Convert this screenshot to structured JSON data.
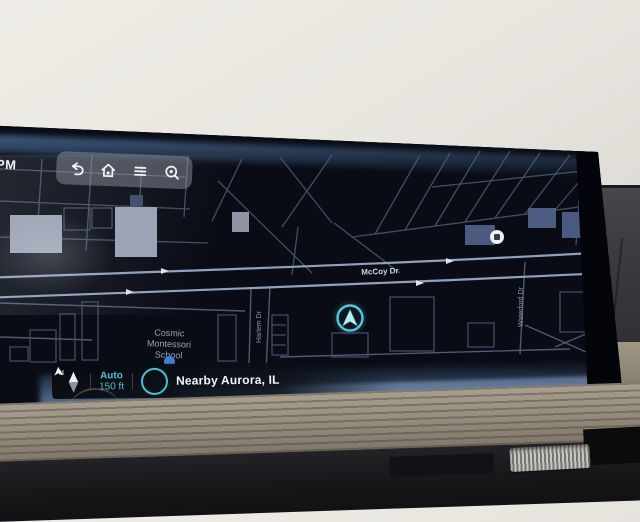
{
  "infotainment": {
    "clock_partial": "PM",
    "toolbar": {
      "icons": [
        {
          "name": "back"
        },
        {
          "name": "home"
        },
        {
          "name": "menu"
        },
        {
          "name": "search"
        }
      ]
    },
    "map": {
      "streets": {
        "mccoy": "McCoy Dr",
        "harlem": "Harlem Dr",
        "waterford": "Waterford Dr"
      },
      "school": {
        "line1": "Cosmic",
        "line2": "Montessori",
        "line3": "School"
      }
    },
    "statusbar": {
      "compass": "N",
      "zoom_mode": "Auto",
      "zoom_scale": "150 ft",
      "location_label": "Nearby Aurora, IL"
    },
    "colors": {
      "accent_teal": "#3fc3d2",
      "glow_blue": "#6fa6e0",
      "road": "#8ea2bc",
      "map_background": "#080b12"
    }
  }
}
